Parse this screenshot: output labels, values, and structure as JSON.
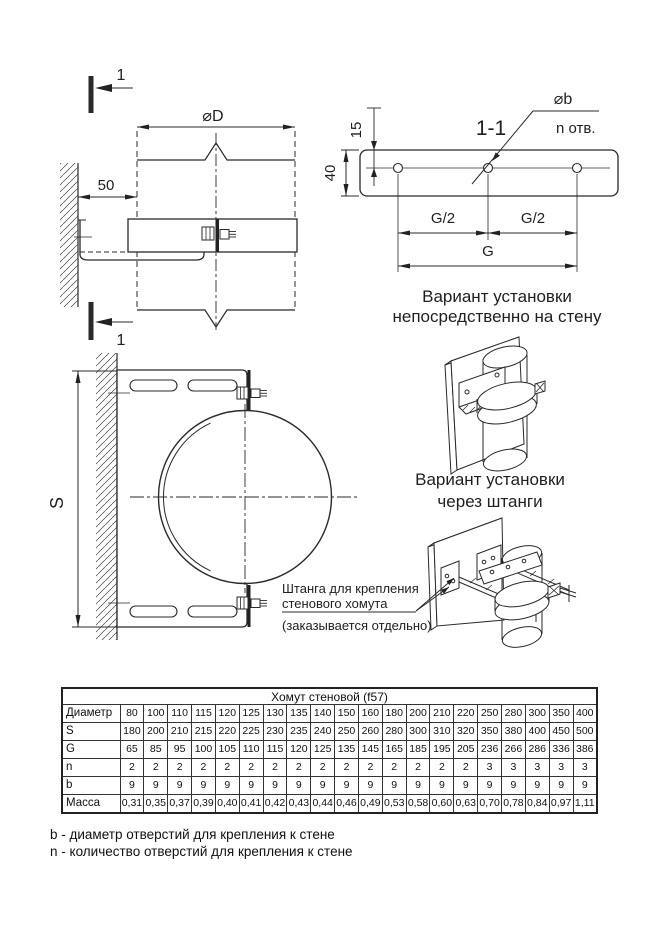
{
  "colors": {
    "ink": "#222222",
    "paper": "#ffffff"
  },
  "side_view": {
    "section_mark": "1",
    "diameter_label": "⌀D",
    "wall_offset": "50"
  },
  "section_view": {
    "title": "1-1",
    "hole_diameter_label": "⌀b",
    "holes_note": "n отв.",
    "edge_to_hole": "15",
    "strip_height": "40",
    "half_span_left": "G/2",
    "half_span_right": "G/2",
    "span": "G"
  },
  "front_view": {
    "height_label": "S"
  },
  "captions": {
    "direct_line1": "Вариант установки",
    "direct_line2": "непосредственно на стену",
    "rods_line1": "Вариант установки",
    "rods_line2": "через штанги"
  },
  "annotation": {
    "line1": "Штанга для крепления",
    "line2": "стенового хомута",
    "note": "(заказывается отдельно)"
  },
  "table": {
    "title": "Хомут стеновой (f57)",
    "rows": [
      {
        "label": "Диаметр",
        "values": [
          "80",
          "100",
          "110",
          "115",
          "120",
          "125",
          "130",
          "135",
          "140",
          "150",
          "160",
          "180",
          "200",
          "210",
          "220",
          "250",
          "280",
          "300",
          "350",
          "400"
        ]
      },
      {
        "label": "S",
        "values": [
          "180",
          "200",
          "210",
          "215",
          "220",
          "225",
          "230",
          "235",
          "240",
          "250",
          "260",
          "280",
          "300",
          "310",
          "320",
          "350",
          "380",
          "400",
          "450",
          "500"
        ]
      },
      {
        "label": "G",
        "values": [
          "65",
          "85",
          "95",
          "100",
          "105",
          "110",
          "115",
          "120",
          "125",
          "135",
          "145",
          "165",
          "185",
          "195",
          "205",
          "236",
          "266",
          "286",
          "336",
          "386"
        ]
      },
      {
        "label": "n",
        "values": [
          "2",
          "2",
          "2",
          "2",
          "2",
          "2",
          "2",
          "2",
          "2",
          "2",
          "2",
          "2",
          "2",
          "2",
          "2",
          "3",
          "3",
          "3",
          "3",
          "3"
        ]
      },
      {
        "label": "b",
        "values": [
          "9",
          "9",
          "9",
          "9",
          "9",
          "9",
          "9",
          "9",
          "9",
          "9",
          "9",
          "9",
          "9",
          "9",
          "9",
          "9",
          "9",
          "9",
          "9",
          "9"
        ]
      },
      {
        "label": "Масса",
        "values": [
          "0,31",
          "0,35",
          "0,37",
          "0,39",
          "0,40",
          "0,41",
          "0,42",
          "0,43",
          "0,44",
          "0,46",
          "0,49",
          "0,53",
          "0,58",
          "0,60",
          "0,63",
          "0,70",
          "0,78",
          "0,84",
          "0,97",
          "1,11"
        ]
      }
    ]
  },
  "notes": {
    "b": "b - диаметр отверстий для крепления к стене",
    "n": "n - количество отверстий для крепления к стене"
  }
}
